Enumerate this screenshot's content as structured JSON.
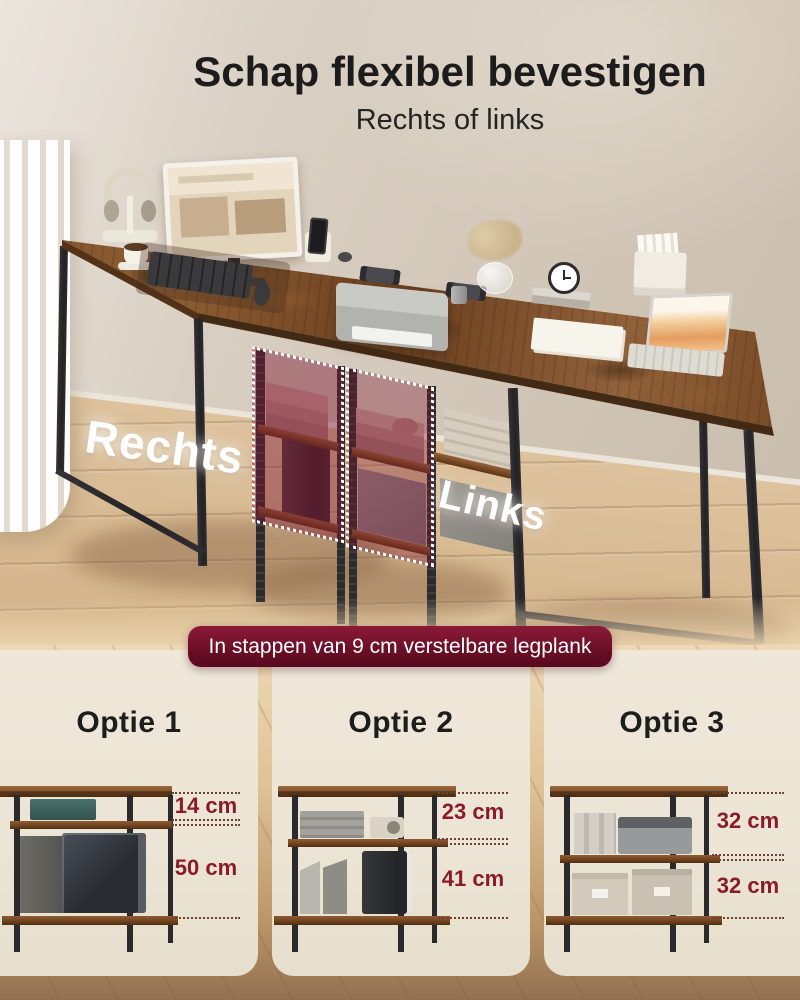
{
  "header": {
    "title": "Schap flexibel bevestigen",
    "subtitle": "Rechts of links"
  },
  "scene": {
    "label_rechts": "Rechts",
    "label_links": "Links"
  },
  "banner": {
    "text": "In stappen van 9 cm verstelbare legplank"
  },
  "options": [
    {
      "label": "Optie 1",
      "measurements": [
        "14 cm",
        "50 cm"
      ]
    },
    {
      "label": "Optie 2",
      "measurements": [
        "23 cm",
        "41 cm"
      ]
    },
    {
      "label": "Optie 3",
      "measurements": [
        "32 cm",
        "32 cm"
      ]
    }
  ],
  "colors": {
    "accent_maroon": "#6d0f28",
    "measurement_red": "#8a1b2c",
    "panel_cream": "#ede6d7",
    "wall_beige": "#d6cbbd",
    "desk_wood": "#7a4c28",
    "frame_black": "#29292b",
    "highlight_pink": "rgba(124,22,48,0.45)"
  }
}
